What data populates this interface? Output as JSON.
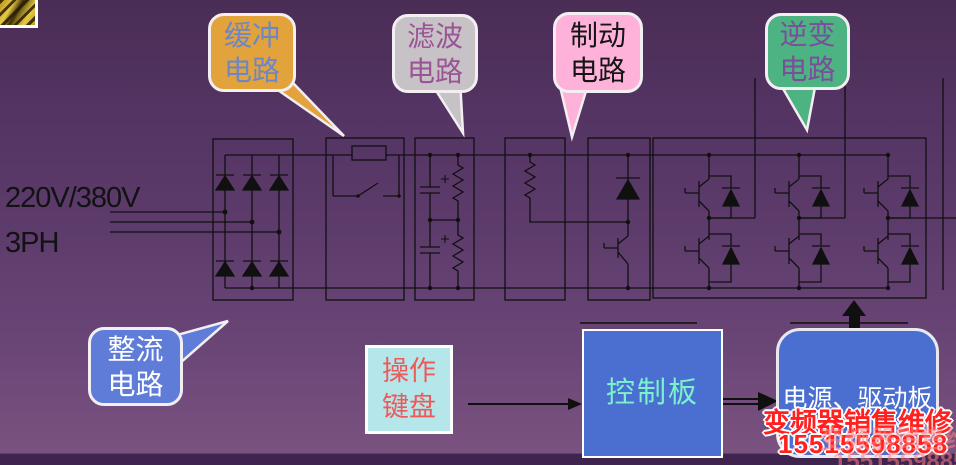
{
  "input_label": {
    "line1": "220V/380V",
    "line2": "3PH"
  },
  "callouts": {
    "buffer": {
      "line1": "缓冲",
      "line2": "电路",
      "bg": "#E2A33C",
      "text_color": "#6D87C6"
    },
    "filter": {
      "line1": "滤波",
      "line2": "电路",
      "bg": "#C6C2C6",
      "text_color": "#9B5496"
    },
    "brake": {
      "line1": "制动",
      "line2": "电路",
      "bg": "#FFB2D9",
      "text_color": "#151515"
    },
    "inverter": {
      "line1": "逆变",
      "line2": "电路",
      "bg": "#4EB382",
      "text_color": "#7A4E9B"
    },
    "rectifier": {
      "line1": "整流",
      "line2": "电路",
      "bg": "#5F7CD8",
      "text_color": "#FFFFFF"
    }
  },
  "blocks": {
    "keypad": {
      "line1": "操作",
      "line2": "键盘",
      "bg": "#B5E6E9",
      "text_color": "#EE5A5A"
    },
    "control_board": {
      "label": "控制板",
      "bg": "#4A6FD0",
      "text_color": "#7BF2CB"
    },
    "power_drive_board": {
      "label": "电源、驱动板",
      "bg": "#4A6FD0",
      "text_color": "#FFFFFF"
    }
  },
  "watermark": {
    "line1": "变频器销售维修",
    "line2": "15515598858",
    "color": "#FF2020"
  },
  "circuit": {
    "line_color": "#101010",
    "sections": [
      "rectifier-bridge",
      "buffer-circuit",
      "filter-circuit",
      "brake-resistor",
      "brake-chopper",
      "inverter-bridge"
    ]
  }
}
